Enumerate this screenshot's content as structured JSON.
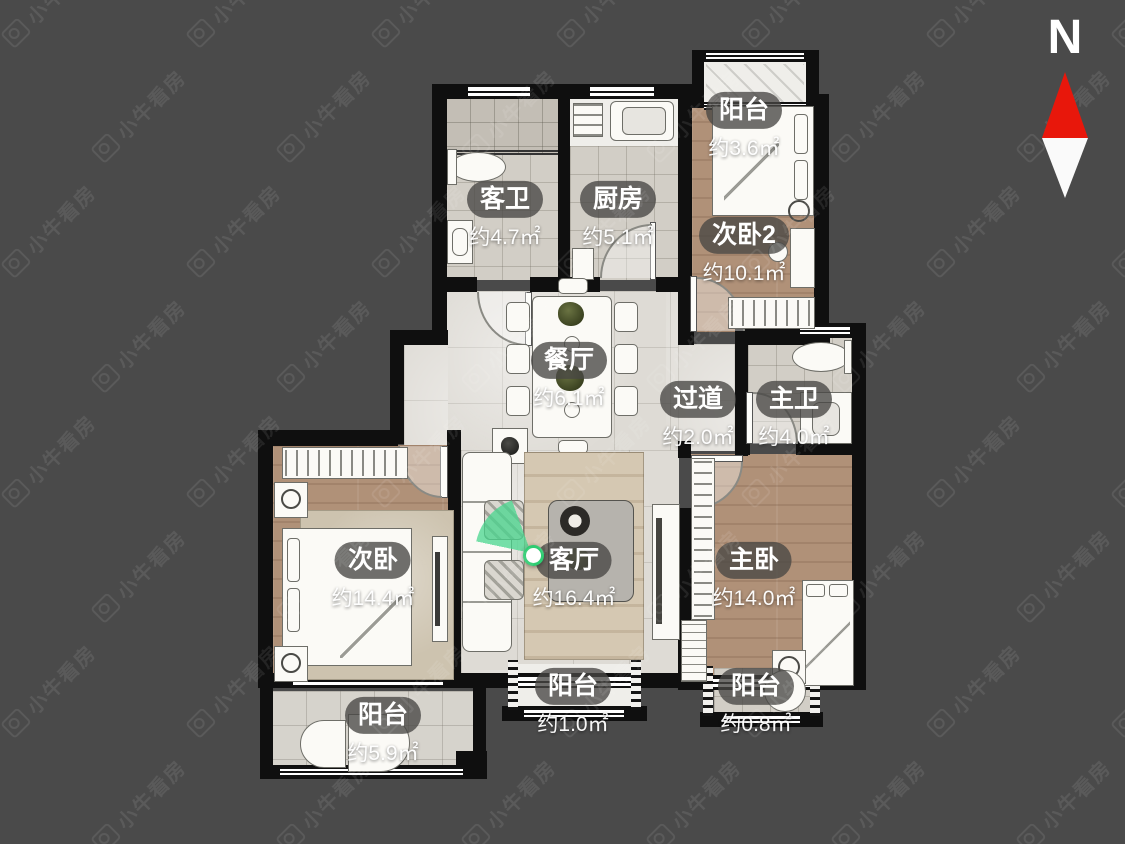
{
  "watermark": {
    "text": "小牛看房"
  },
  "compass": {
    "label": "N"
  },
  "colors": {
    "background": "#4a4a4a",
    "wall": "#0f0f0f",
    "compass_north": "#e8170b",
    "marker_green": "#2ecc71"
  },
  "rooms": [
    {
      "id": "guest-bath",
      "name": "客卫",
      "area": "约4.7㎡"
    },
    {
      "id": "kitchen",
      "name": "厨房",
      "area": "约5.1㎡"
    },
    {
      "id": "balcony-top",
      "name": "阳台",
      "area": "约3.6㎡"
    },
    {
      "id": "bedroom2",
      "name": "次卧2",
      "area": "约10.1㎡"
    },
    {
      "id": "dining",
      "name": "餐厅",
      "area": "约6.1㎡"
    },
    {
      "id": "hallway",
      "name": "过道",
      "area": "约2.0㎡"
    },
    {
      "id": "master-bath",
      "name": "主卫",
      "area": "约4.0㎡"
    },
    {
      "id": "bedroom",
      "name": "次卧",
      "area": "约14.4㎡"
    },
    {
      "id": "living",
      "name": "客厅",
      "area": "约16.4㎡"
    },
    {
      "id": "master-bedroom",
      "name": "主卧",
      "area": "约14.0㎡"
    },
    {
      "id": "balcony-left",
      "name": "阳台",
      "area": "约5.9㎡"
    },
    {
      "id": "balcony-center",
      "name": "阳台",
      "area": "约1.0㎡"
    },
    {
      "id": "balcony-right",
      "name": "阳台",
      "area": "约0.8㎡"
    }
  ]
}
